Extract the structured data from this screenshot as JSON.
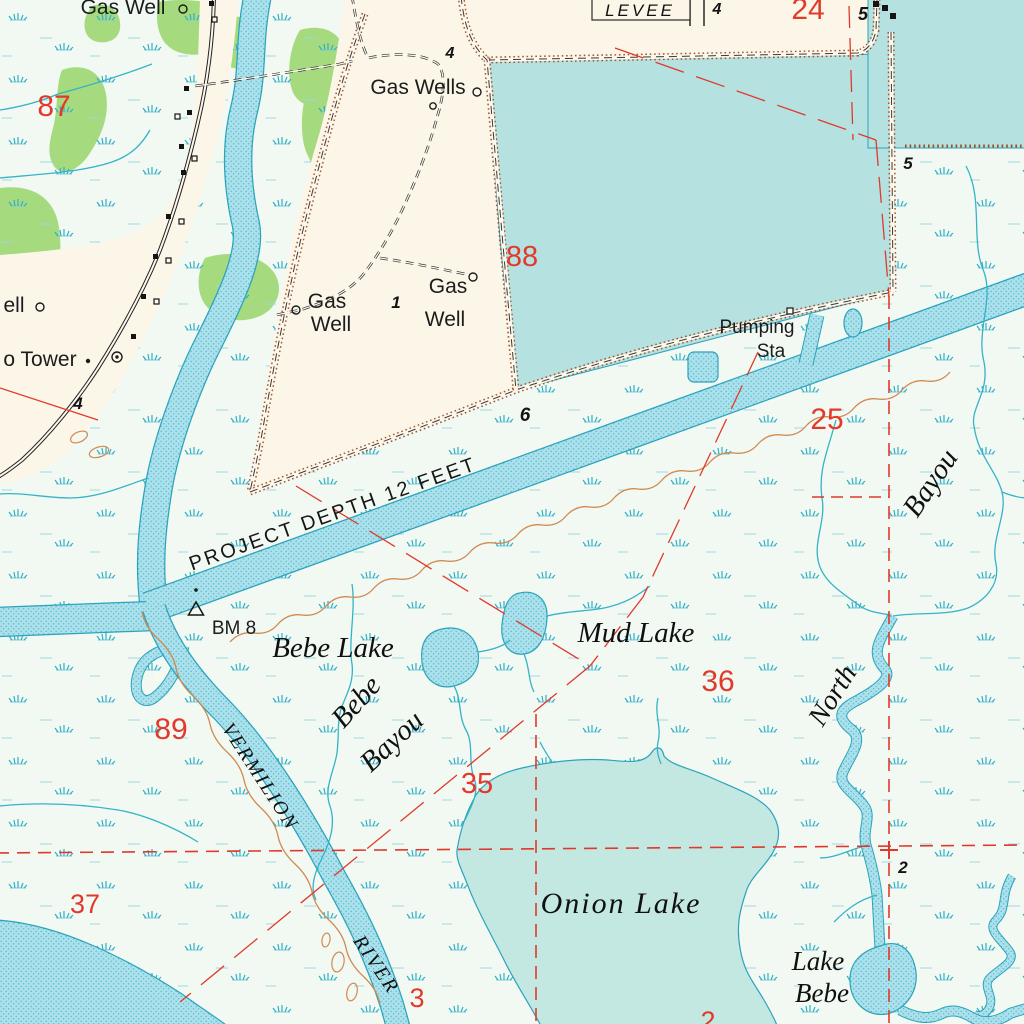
{
  "map": {
    "kind": "topographic-map",
    "colors": {
      "marsh_bg": "#f2f9f2",
      "land_cream": "#fcf6e8",
      "water_flat": "#b5e1e0",
      "water_onion": "#c3e7e1",
      "water_stipple": "#ace0ea",
      "stream": "#35b3c8",
      "vegetation_green": "#a5da7e",
      "levee_brown": "#a14a1e",
      "spoil_brown": "#d08a52",
      "section_red": "#e2392b",
      "road_black": "#222222"
    },
    "symbols": {
      "gas_well": "open-circle-icon",
      "benchmark": "triangle-icon",
      "tower": "circle-dot-icon",
      "building": "filled-square-icon",
      "building_open": "open-square-icon"
    }
  },
  "places": [
    {
      "text": "Gas Well"
    },
    {
      "text": "Gas Wells"
    },
    {
      "text": "Gas"
    },
    {
      "text": "Well"
    },
    {
      "text": "Gas"
    },
    {
      "text": "Well"
    },
    {
      "text": "Pumping"
    },
    {
      "text": "Sta"
    },
    {
      "text": "ell"
    },
    {
      "text": "o Tower"
    },
    {
      "text": "LEVEE"
    },
    {
      "text": "BM 8"
    },
    {
      "text": "PROJECT DEPTH 12 FEET"
    }
  ],
  "waters": [
    {
      "text": "Bebe Lake"
    },
    {
      "text": "Mud Lake"
    },
    {
      "text": "Onion Lake"
    },
    {
      "text": "Lake"
    },
    {
      "text": "Bebe"
    },
    {
      "text": "Bebe"
    },
    {
      "text": "Bayou"
    },
    {
      "text": "North"
    },
    {
      "text": "Bayou"
    },
    {
      "text": "VERMILION"
    },
    {
      "text": "RIVER"
    }
  ],
  "red_numbers": [
    {
      "text": "87"
    },
    {
      "text": "24"
    },
    {
      "text": "88"
    },
    {
      "text": "25"
    },
    {
      "text": "36"
    },
    {
      "text": "89"
    },
    {
      "text": "35"
    },
    {
      "text": "37"
    },
    {
      "text": "3"
    },
    {
      "text": "2"
    }
  ],
  "black_numbers": [
    {
      "text": "4"
    },
    {
      "text": "4"
    },
    {
      "text": "5"
    },
    {
      "text": "5"
    },
    {
      "text": "1"
    },
    {
      "text": "6"
    },
    {
      "text": "4"
    },
    {
      "text": "2"
    }
  ]
}
